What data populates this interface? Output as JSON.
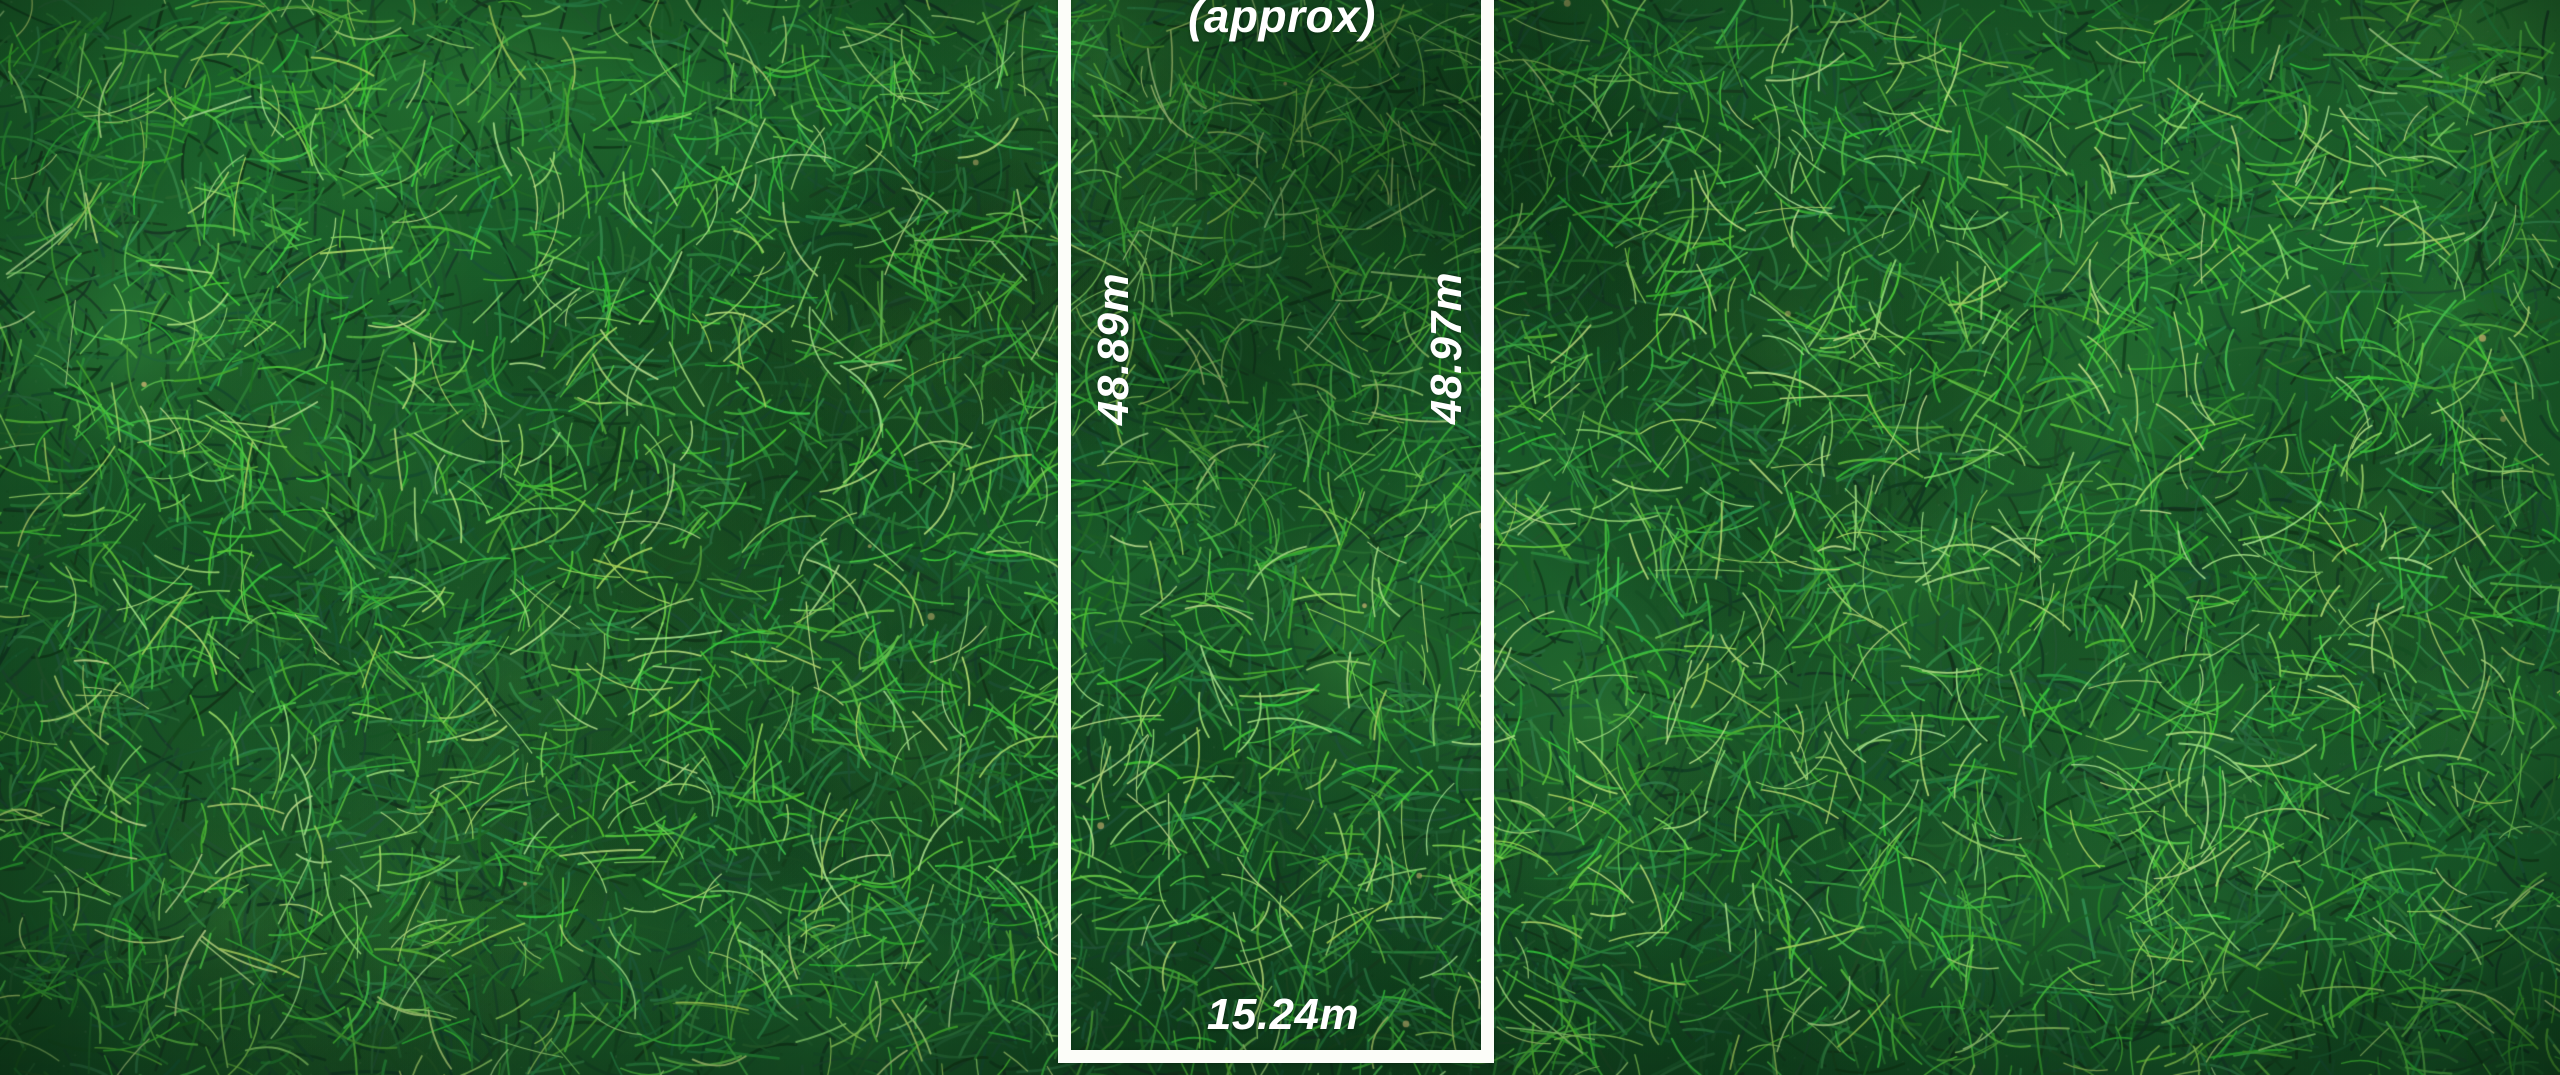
{
  "plot": {
    "approx_note": "(approx)",
    "side_left_length": "48.89m",
    "side_right_length": "48.97m",
    "frontage_width": "15.24m"
  },
  "palette": {
    "boundary_line": "#fcfdf9",
    "dimension_text": "#ffffff",
    "grass_base_top": "#1f6c30",
    "grass_base_bottom": "#18592a",
    "grass_deep_shadow": "#0d3a18",
    "grass_mid": "#2f8c3e",
    "grass_light": "#5cb74b",
    "grass_highlight": "#b8d973",
    "debris_tan": "#c8b571"
  }
}
